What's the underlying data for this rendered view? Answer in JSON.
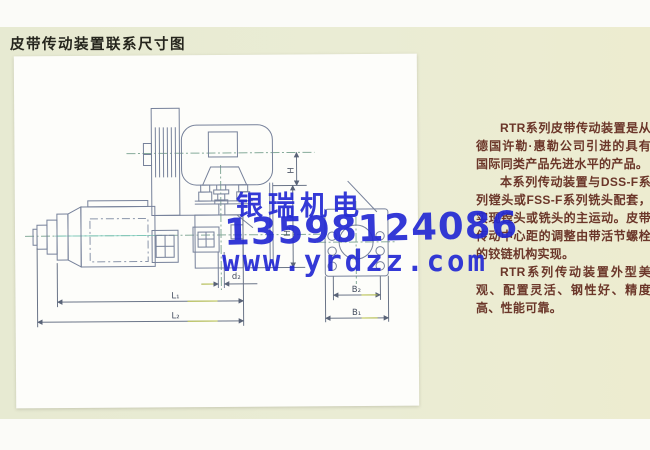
{
  "page": {
    "title": "皮带传动装置联系尺寸图"
  },
  "watermark": {
    "company": "银瑞机电",
    "phone": "13598124086",
    "website": "www.yrdzz.com",
    "color": "#2329d4"
  },
  "description": {
    "p1": "RTR系列皮带传动装置是从德国许勒·惠勒公司引进的具有国际同类产品先进水平的产品。",
    "p2": "本系列传动装置与DSS-F系列镗头或FSS-F系列铣头配套，实现镗头或铣头的主运动。皮带传动中心距的调整由带活节螺栓的铰链机构实现。",
    "p3": "RTR系列传动装置外型美观、配置灵活、钢性好、精度高、性能可靠。",
    "text_color": "#6b3629"
  },
  "diagram": {
    "dims": {
      "h": "H",
      "h2": "H₂",
      "d2": "d₂",
      "l1": "L₁",
      "l2": "L₂",
      "b2": "B₂",
      "b1": "B₁"
    }
  },
  "colors": {
    "page_bg": "#eaecd4",
    "panel_bg": "#fdfdfa",
    "line": "#76819a",
    "centerline": "#86ab9a",
    "title_text": "#25251d"
  }
}
